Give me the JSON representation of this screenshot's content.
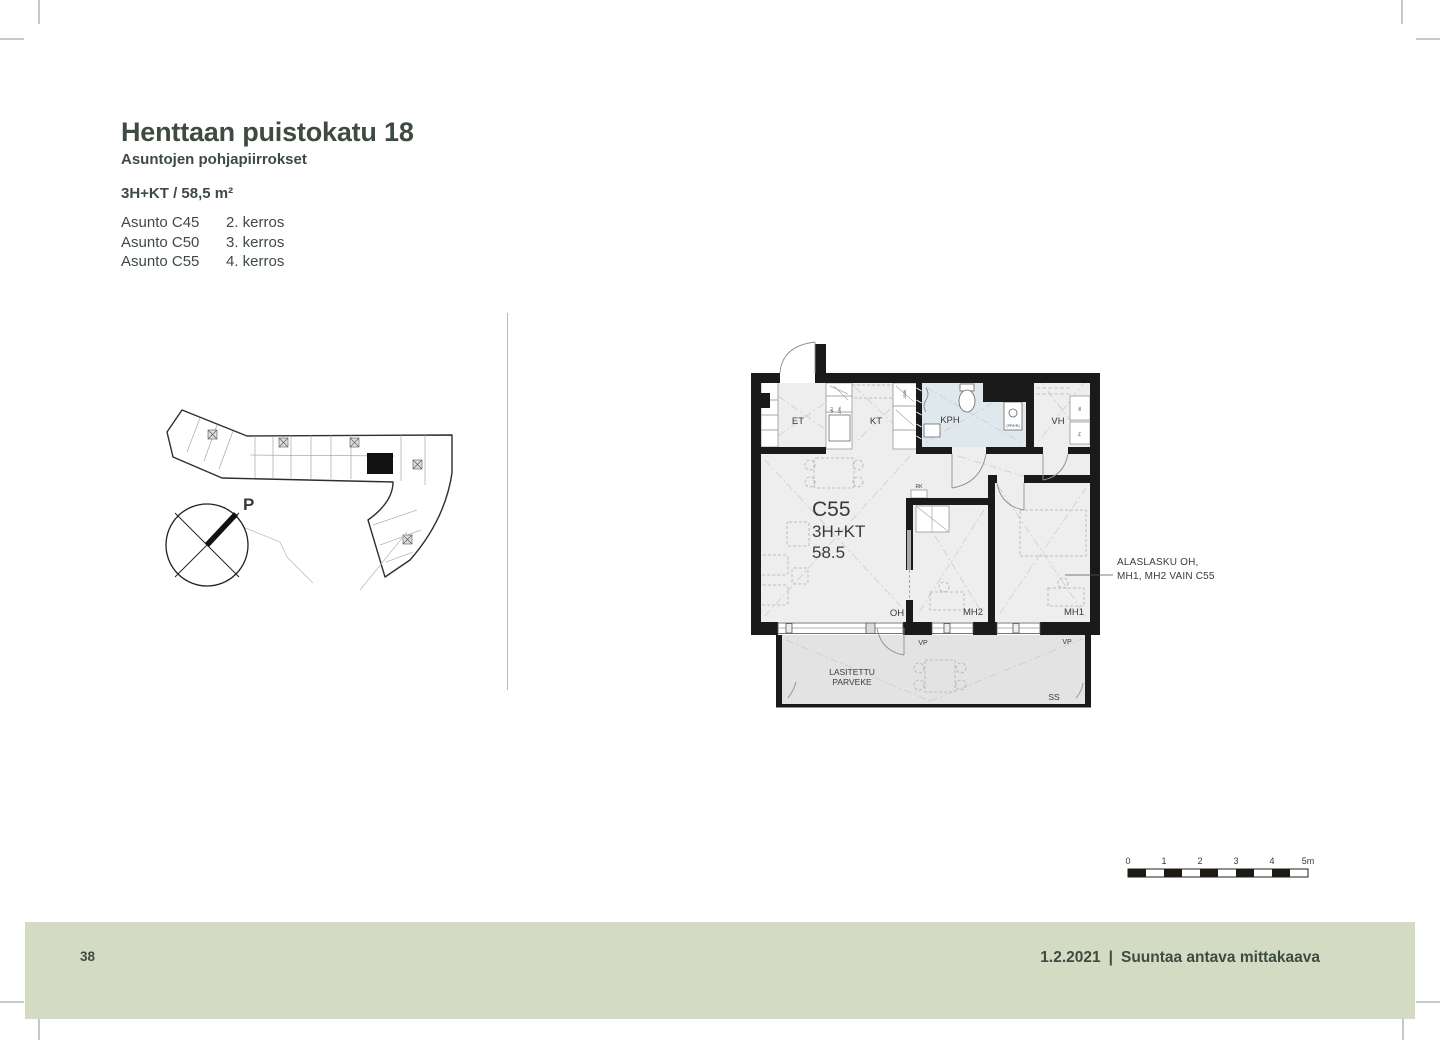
{
  "header": {
    "title": "Henttaan puistokatu 18",
    "subtitle": "Asuntojen pohjapiirrokset",
    "apartment_type": "3H+KT / 58,5 m²",
    "apartments": [
      {
        "unit": "Asunto C45",
        "floor": "2. kerros"
      },
      {
        "unit": "Asunto C50",
        "floor": "3. kerros"
      },
      {
        "unit": "Asunto C55",
        "floor": "4. kerros"
      }
    ]
  },
  "overview": {
    "compass_label": "P"
  },
  "floorplan": {
    "unit_id": "C55",
    "unit_type": "3H+KT",
    "unit_area": "58.5",
    "rooms": {
      "et": "ET",
      "kt": "KT",
      "kph": "KPH",
      "vh": "VH",
      "oh": "OH",
      "mh2": "MH2",
      "mh1": "MH1"
    },
    "small_labels": {
      "rk": "RK",
      "vp1": "VP",
      "vp2": "VP",
      "ss": "SS",
      "mu": "MU",
      "apk": "APK",
      "jaak": "JÄÄK",
      "ppkr": "(PP/KR)",
      "sk": "SK",
      "py": "PY"
    },
    "balcony_line1": "LASITETTU",
    "balcony_line2": "PARVEKE",
    "annotation_line1": "ALASLASKU OH,",
    "annotation_line2": "MH1, MH2 VAIN C55"
  },
  "scalebar": {
    "ticks": [
      "0",
      "1",
      "2",
      "3",
      "4",
      "5m"
    ]
  },
  "footer": {
    "page_number": "38",
    "date": "1.2.2021",
    "separator": "|",
    "note": "Suuntaa antava mittakaava"
  },
  "colors": {
    "accent_green": "#3d4b41",
    "footer_bg": "#d4dbc3",
    "wall": "#1a1a1a",
    "floor": "#eeeeee",
    "bathroom": "#dfe9ed",
    "balcony": "#e3e3e3"
  }
}
